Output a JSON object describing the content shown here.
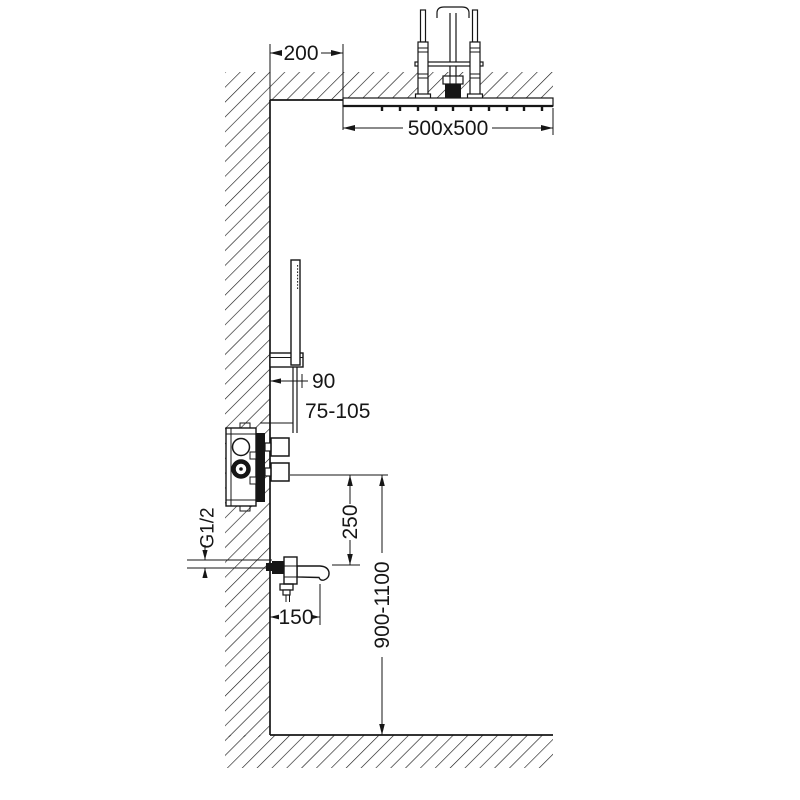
{
  "drawing": {
    "kind": "shower-system-installation-dimension-diagram",
    "colors": {
      "line": "#161616",
      "background": "#ffffff"
    },
    "dimensions": {
      "ceiling_offset": "200",
      "shower_head_size": "500x500",
      "hand_shower_offset": "90",
      "valve_depth_range": "75-105",
      "valve_to_spout_distance": "250",
      "spout_height_range": "900-1100",
      "thread_size": "G1/2",
      "spout_reach": "150"
    },
    "components": [
      "ceiling-section",
      "wall-section",
      "floor-section",
      "ceiling-shower-head",
      "mounting-rods",
      "supply-pipe",
      "hand-shower",
      "hand-shower-holder",
      "hand-shower-hose",
      "concealed-mixer-valve",
      "valve-handles",
      "bath-spout"
    ]
  }
}
